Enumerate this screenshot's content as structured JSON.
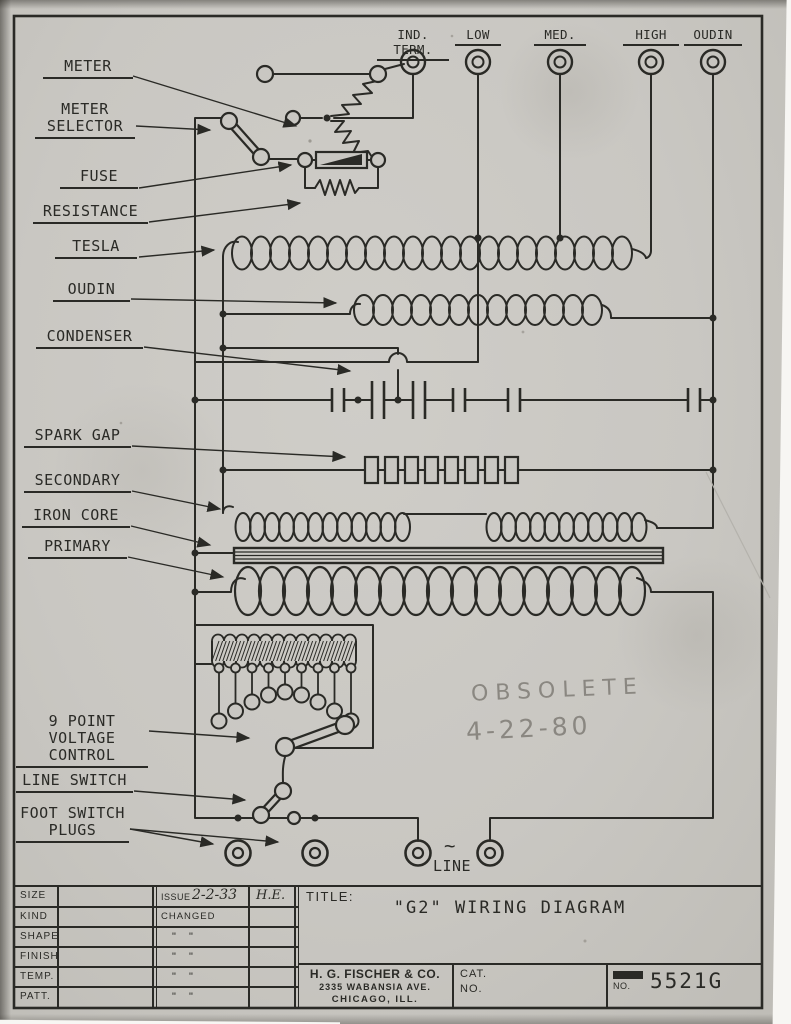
{
  "colors": {
    "ink": "#2a2a26",
    "paper": "#c9c7c2",
    "pencil": "#8a8781"
  },
  "terminals": {
    "ind_term": "IND. TERM.",
    "low": "LOW",
    "med": "MED.",
    "high": "HIGH",
    "oudin": "OUDIN"
  },
  "component_labels": {
    "meter": "METER",
    "selector_line1": "METER",
    "selector_line2": "SELECTOR",
    "fuse": "FUSE",
    "resistance": "RESISTANCE",
    "tesla": "TESLA",
    "oudin": "OUDIN",
    "condenser": "CONDENSER",
    "spark_gap": "SPARK GAP",
    "secondary": "SECONDARY",
    "iron_core": "IRON CORE",
    "primary": "PRIMARY",
    "vcontrol_line1": "9 POINT VOLTAGE",
    "vcontrol_line2": "CONTROL",
    "line_switch": "LINE SWITCH",
    "foot_line1": "FOOT SWITCH",
    "foot_line2": "PLUGS"
  },
  "bottom_labels": {
    "tilde": "~",
    "line": "LINE"
  },
  "handwriting": {
    "obsolete": "OBSOLETE",
    "date": "4-22-80"
  },
  "title_block": {
    "rows": [
      "SIZE",
      "KIND",
      "SHAPE",
      "FINISH",
      "TEMP.",
      "PATT."
    ],
    "issue_label": "ISSUE",
    "issue_date": "2-2-33",
    "issue_initials": "H.E.",
    "changed": "CHANGED",
    "ditto": "\"      \"",
    "title_label": "TITLE:",
    "title": "\"G2\" WIRING DIAGRAM",
    "company": "H. G. FISCHER & CO.",
    "address": "2335 WABANSIA AVE.",
    "city": "CHICAGO, ILL.",
    "cat_line1": "CAT.",
    "cat_line2": "NO.",
    "no_label": "NO.",
    "drawing_number": "5521G"
  }
}
